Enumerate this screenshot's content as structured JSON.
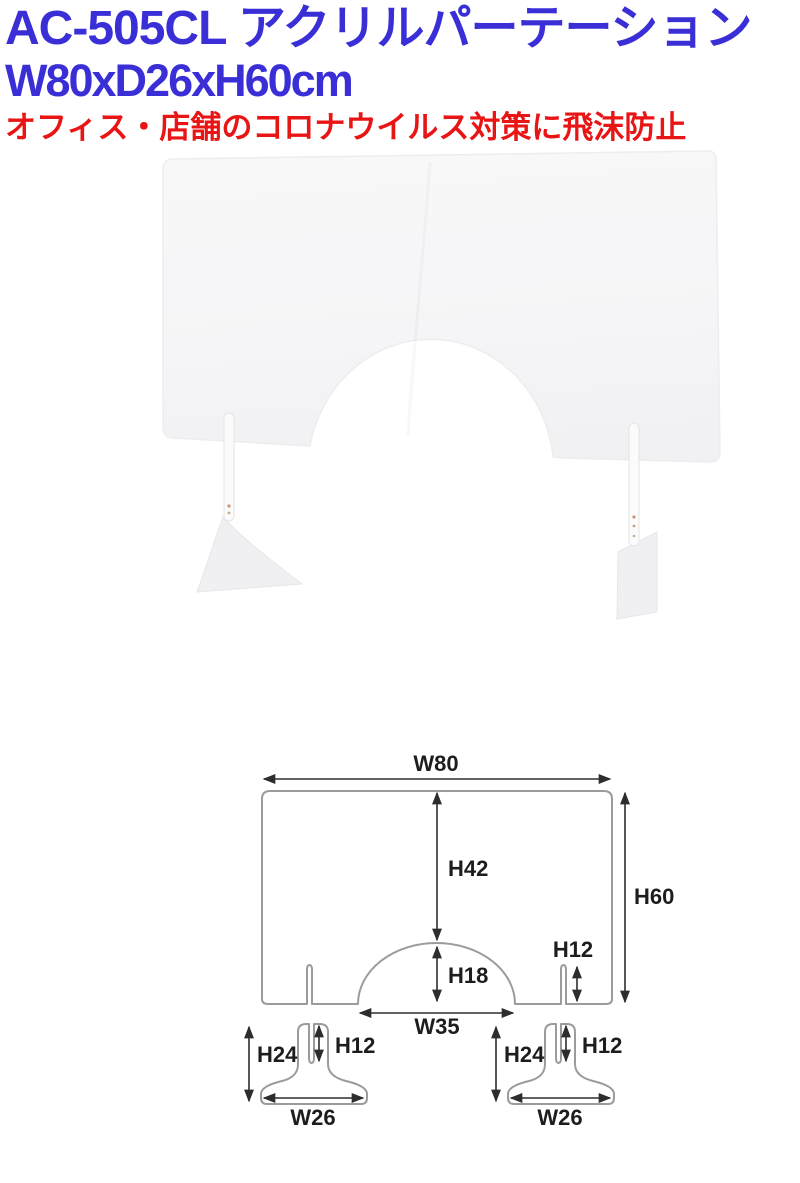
{
  "page": {
    "background": "#ffffff"
  },
  "header": {
    "model_title": "AC-505CL アクリルパーテーション",
    "size_title": "W80xD26xH60cm",
    "tagline": "オフィス・店舗のコロナウイルス対策に飛沫防止",
    "title_color": "#3a2fd6",
    "tagline_color": "#e91414"
  },
  "diagram": {
    "stroke_color": "#9b9b9b",
    "arrow_color": "#2d2d2d",
    "label_color": "#1d1d1d",
    "panel": {
      "width": "W80",
      "height": "H60",
      "top_to_opening": "H42",
      "opening_height": "H18",
      "opening_width": "W35",
      "slot_height": "H12"
    },
    "foot_left": {
      "height": "H24",
      "slot_height": "H12",
      "width": "W26"
    },
    "foot_right": {
      "height": "H24",
      "slot_height": "H12",
      "width": "W26"
    }
  }
}
